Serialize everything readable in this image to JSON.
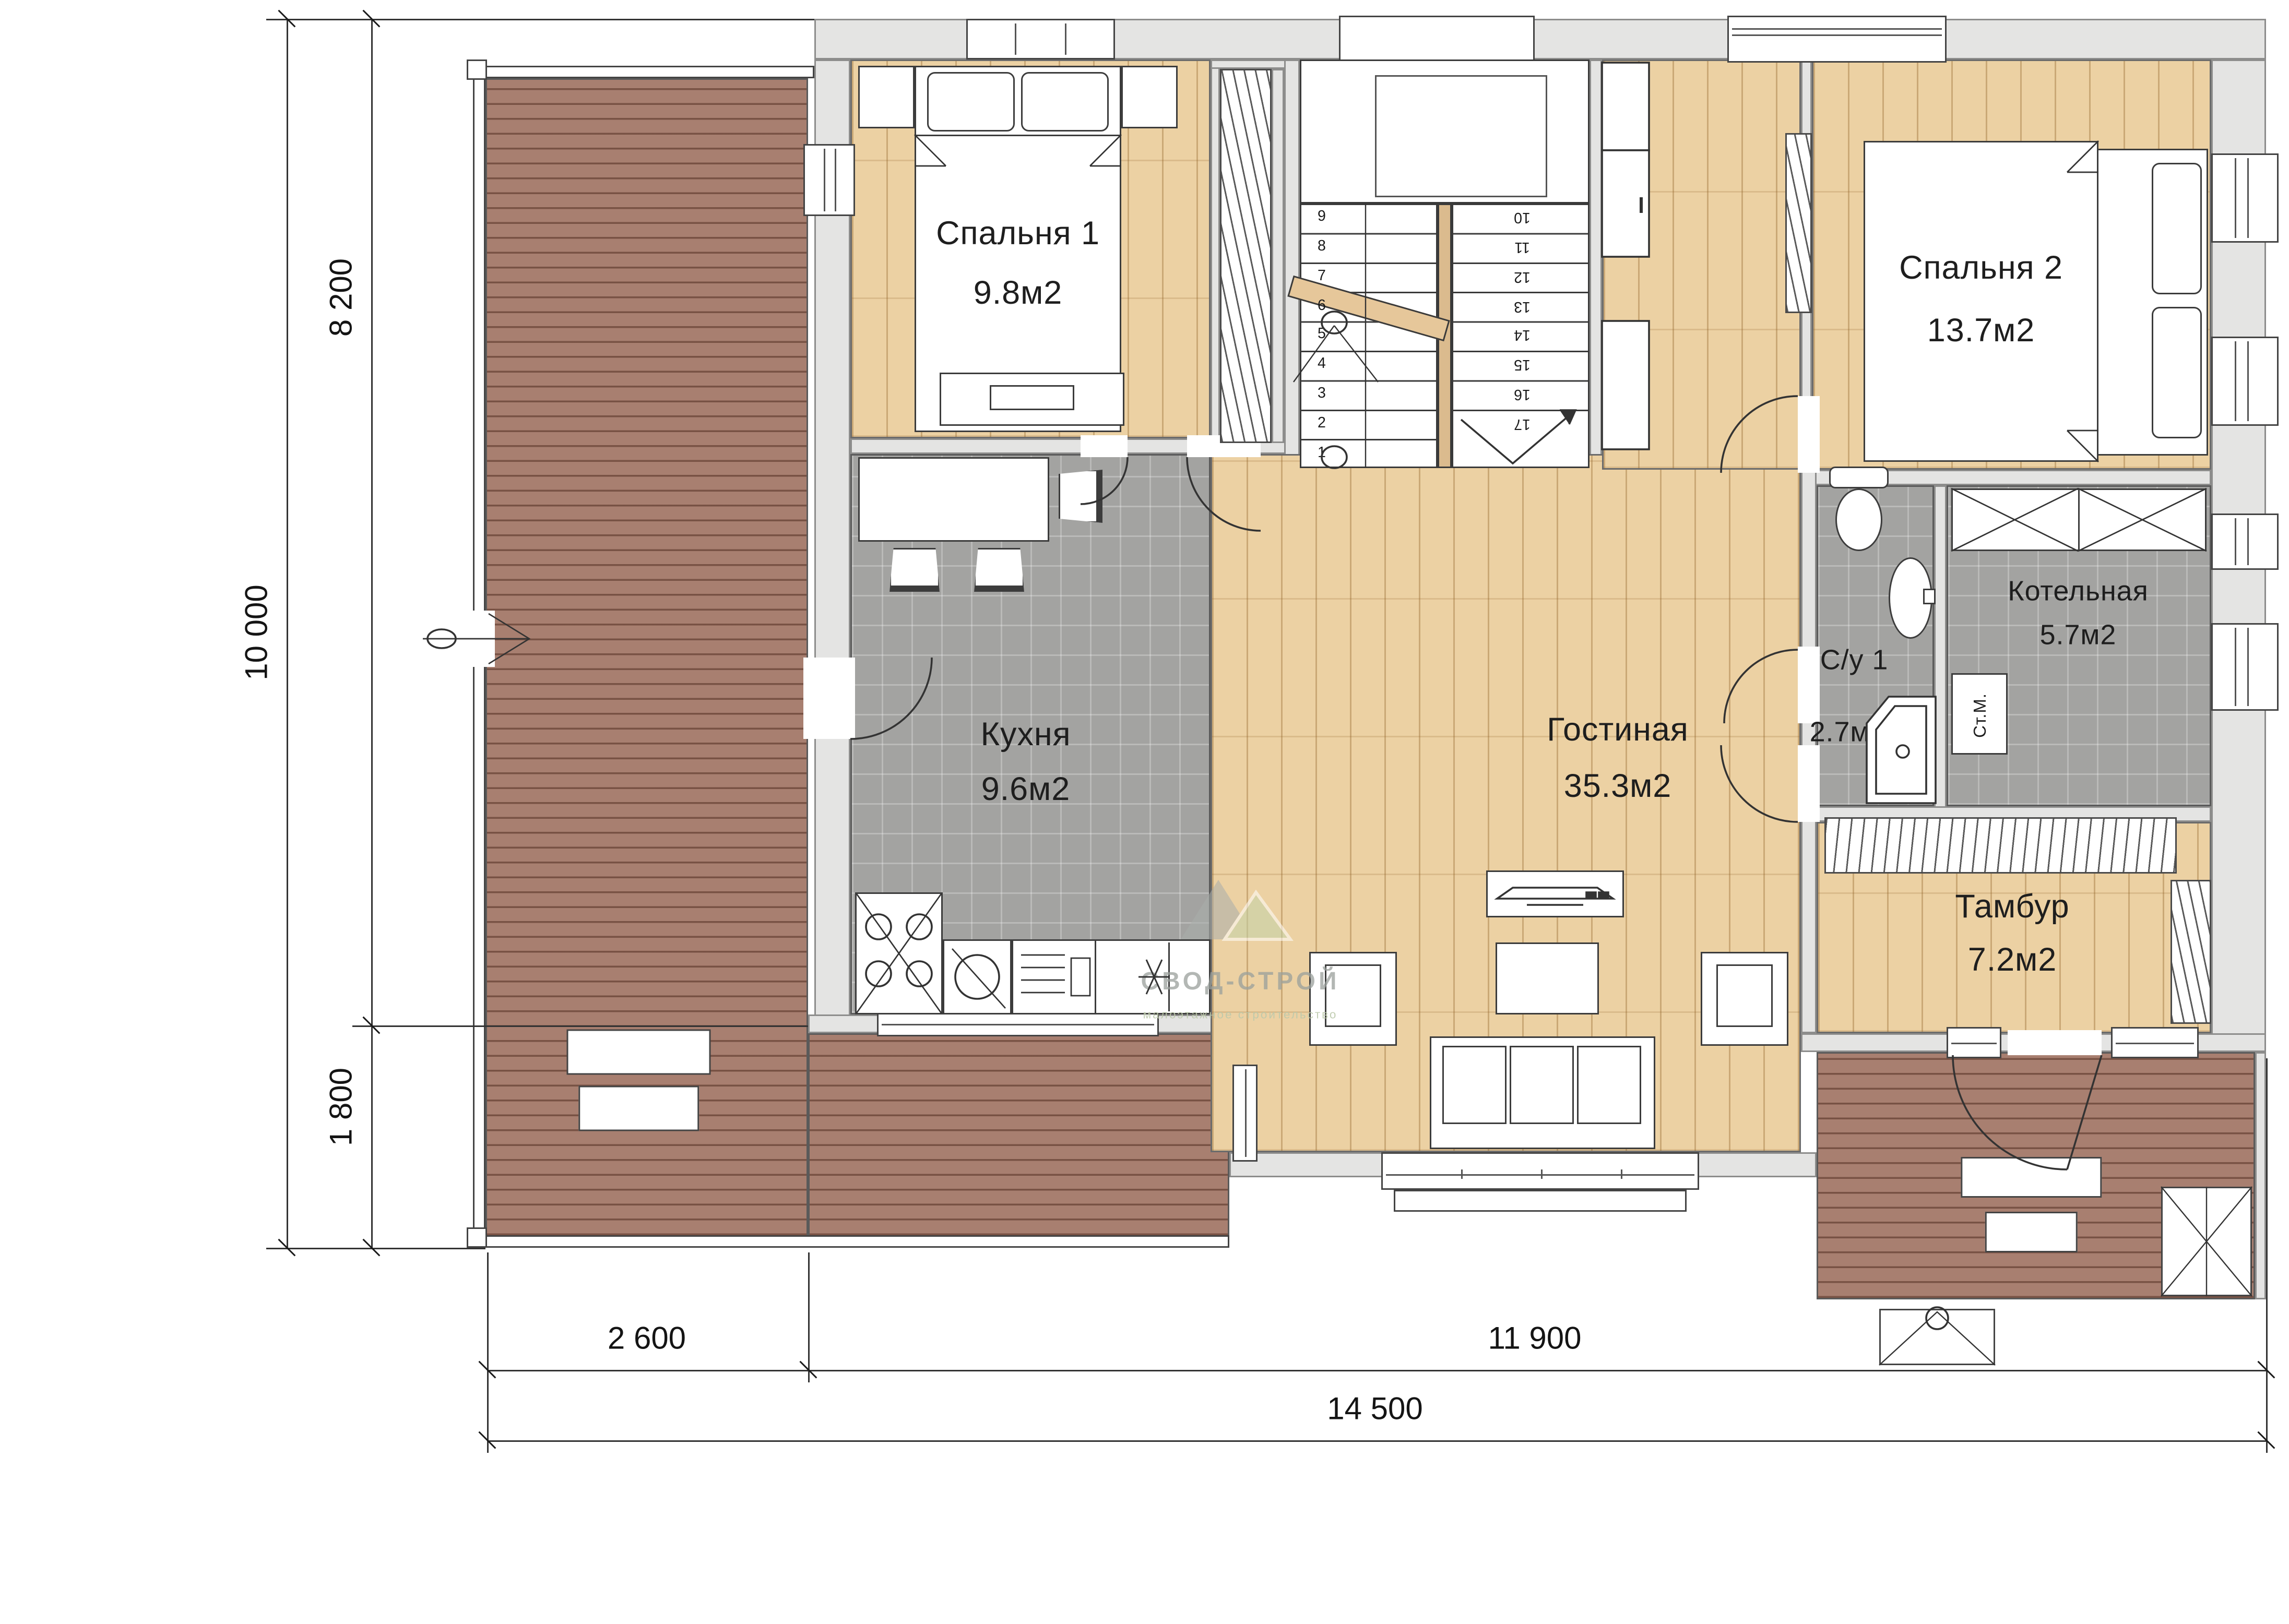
{
  "rooms": [
    {
      "name": "Спальня 1",
      "area": "9.8м2"
    },
    {
      "name": "Спальня 2",
      "area": "13.7м2"
    },
    {
      "name": "Кухня",
      "area": "9.6м2"
    },
    {
      "name": "Гостиная",
      "area": "35.3м2"
    },
    {
      "name": "Котельная",
      "area": "5.7м2"
    },
    {
      "name": "С/у 1",
      "area": "2.7м2"
    },
    {
      "name": "Тамбур",
      "area": "7.2м2"
    },
    {
      "name": "Крыльцо",
      "area": "6.5м2"
    },
    {
      "name": "Терраса",
      "area": "31.5м2"
    }
  ],
  "appliances": {
    "washer": "Ст.М."
  },
  "stairs": {
    "left": [
      "9",
      "8",
      "7",
      "6",
      "5",
      "4",
      "3",
      "2",
      "1"
    ],
    "right": [
      "10",
      "11",
      "12",
      "13",
      "14",
      "15",
      "16",
      "17"
    ]
  },
  "dimensions": {
    "left": [
      "10 000",
      "8 200",
      "1 800"
    ],
    "bottom": [
      "2 600",
      "11 900",
      "14 500"
    ]
  },
  "watermark": {
    "brand": "СВОД-СТРОЙ",
    "tagline": "малоэтажное строительство"
  },
  "colors": {
    "wall": "#e4e4e3",
    "deck": "#a87f70",
    "wood": "#ecd1a3",
    "tile": "#a3a3a1",
    "line": "#3c3c3c",
    "label": "#1e1e1e",
    "deck_label": "#ffffff"
  }
}
